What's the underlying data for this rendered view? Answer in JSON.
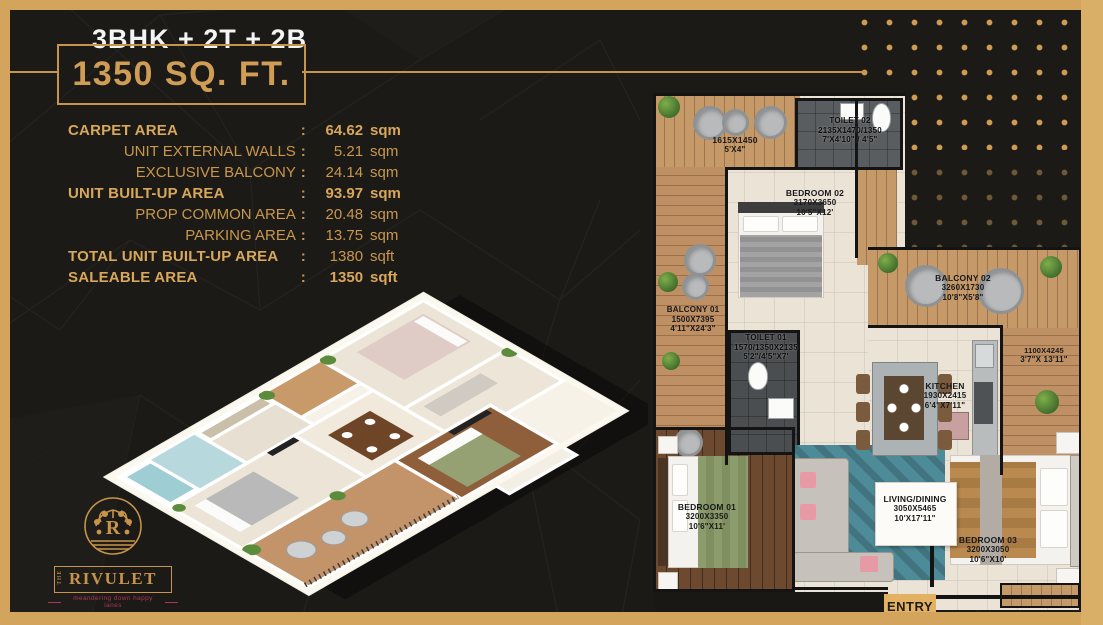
{
  "header": {
    "unit_type": "3BHK + 2T + 2B",
    "area_headline": "1350 SQ. FT."
  },
  "area_details": {
    "separator": ":",
    "rows": [
      {
        "label": "CARPET AREA",
        "value": "64.62",
        "unit": "sqm"
      },
      {
        "label": "UNIT EXTERNAL WALLS",
        "value": "5.21",
        "unit": "sqm"
      },
      {
        "label": "EXCLUSIVE BALCONY",
        "value": "24.14",
        "unit": "sqm"
      },
      {
        "label": "UNIT BUILT-UP AREA",
        "value": "93.97",
        "unit": "sqm"
      },
      {
        "label": "PROP COMMON AREA",
        "value": "20.48",
        "unit": "sqm"
      },
      {
        "label": "PARKING AREA",
        "value": "13.75",
        "unit": "sqm"
      },
      {
        "label": "TOTAL UNIT BUILT-UP AREA",
        "value": "1380",
        "unit": "sqft"
      },
      {
        "label": "SALEABLE AREA",
        "value": "1350",
        "unit": "sqft"
      }
    ]
  },
  "logo": {
    "prefix": "THE",
    "brand": "RIVULET",
    "monogram": "R",
    "tagline": "meandering down happy lanes"
  },
  "floor_plan": {
    "entry_label": "ENTRY",
    "rooms": {
      "deck": {
        "dims": "1615X1450",
        "feet": "5'X4\""
      },
      "toilet_02": {
        "name": "TOILET 02",
        "dims": "2135X1470/1350",
        "feet": "7'X4'10\" / 4'5\""
      },
      "bedroom_02": {
        "name": "BEDROOM 02",
        "dims": "3170X3650",
        "feet": "10'5\"X12'"
      },
      "balcony_01": {
        "name": "BALCONY 01",
        "dims": "1500X7395",
        "feet": "4'11\"X24'3\""
      },
      "toilet_01": {
        "name": "TOILET 01",
        "dims": "1570/1350X2135",
        "feet": "5'2\"/4'5\"X7'"
      },
      "balcony_02": {
        "name": "BALCONY 02",
        "dims": "3260X1730",
        "feet": "10'8\"X5'8\""
      },
      "kitchen": {
        "name": "KITCHEN",
        "dims": "1930X2415",
        "feet": "6'4\"X7'11\""
      },
      "side_balcony": {
        "dims": "1100X4245",
        "feet": "3'7\"X 13'11\""
      },
      "bedroom_01": {
        "name": "BEDROOM 01",
        "dims": "3200X3350",
        "feet": "10'6\"X11'"
      },
      "living_dining": {
        "name": "LIVING/DINING",
        "dims": "3050X5465",
        "feet": "10'X17'11\""
      },
      "bedroom_03": {
        "name": "BEDROOM 03",
        "dims": "3200X3050",
        "feet": "10'6\"X10'"
      }
    }
  },
  "colors": {
    "accent_gold": "#d3a55c",
    "background": "#1b1a17",
    "headline_gold": "#cf9d55",
    "tagline_pink": "#a83a55",
    "entry_bg": "#e2b162"
  }
}
